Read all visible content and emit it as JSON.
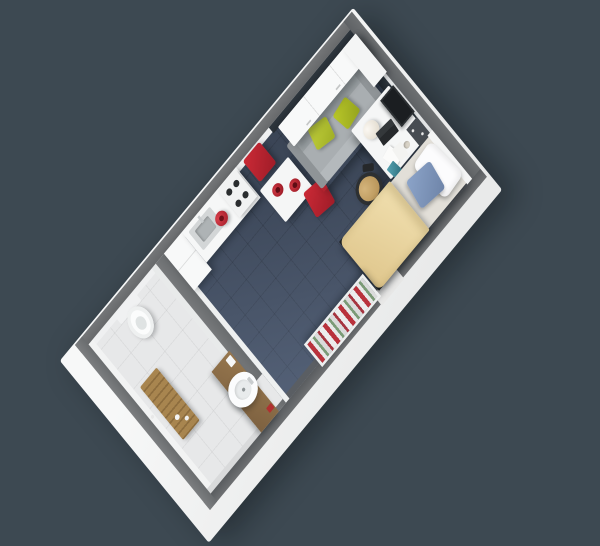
{
  "scene": {
    "description": "Isometric 3D render of a compact studio apartment floor plan with en-suite bathroom, kitchenette, dining table, sofa, study desk and single bed on a dark slate background",
    "background_color": "#3d4952"
  },
  "palette": {
    "bg": "#3d4952",
    "slab": "#f3f4f3",
    "wall": "#6b6e70",
    "wall-dark": "#5c5f62",
    "wall-light": "#7a7c7e",
    "carpet": "#3f4a5c",
    "bath-floor": "#e7e8e9",
    "band": "#2e363d",
    "white": "#f7f8f8",
    "red": "#bf2433",
    "lime": "#b5c431",
    "sofa": "#a9aeb1",
    "sofa-dark": "#8f9497",
    "duvet": "#eedaa9",
    "mattress": "#e2dfd8",
    "pillow-blue": "#8099c0",
    "wood": "#97774e",
    "wood-dark": "#7d6140",
    "teal": "#3a8596",
    "dark": "#222527",
    "steel": "#c9cdcf"
  },
  "rooms": {
    "studio": {
      "label": "Main studio room with dark navy carpet tiles"
    },
    "bathroom": {
      "label": "En-suite bathroom with light grey tiled floor"
    },
    "entry": {
      "label": "Entry door opening in lower wall"
    }
  },
  "furniture": {
    "wall_cabinet": {
      "label": "White overhead storage cupboards above sofa"
    },
    "sofa": {
      "label": "Grey two-seat sofa with two lime green cushions"
    },
    "dining_table": {
      "label": "White square dining table with two red bowls"
    },
    "dining_chair_1": {
      "label": "Red dining chair against wall"
    },
    "dining_chair_2": {
      "label": "Red dining chair beside sofa"
    },
    "kitchen_counter": {
      "label": "White kitchen counter with stainless sink"
    },
    "tall_unit": {
      "label": "Tall white kitchen unit"
    },
    "kettle": {
      "label": "Red kettle on counter"
    },
    "hob": {
      "label": "Four ring hob"
    },
    "desk": {
      "label": "White study desk with sphere lamp, laptop, papers, mug and teal notebook"
    },
    "desk_chair": {
      "label": "Desk chair with tan seat and dark base"
    },
    "monitor": {
      "label": "Wall mounted screen above desk"
    },
    "pinboard": {
      "label": "Dark pinboard with pins above desk"
    },
    "bed": {
      "label": "Single bed with beige duvet, white pillow and slate blue cushion"
    },
    "bookshelf": {
      "label": "Low shelf unit filled with red, green and white books near entry"
    },
    "window_strip": {
      "label": "Dark high-level window strip along upper walls"
    },
    "toilet": {
      "label": "White toilet against bathroom wall"
    },
    "basin": {
      "label": "Round white wash basin on timber vanity shelf"
    },
    "bath_mat": {
      "label": "Timber duckboard bath mat with white toiletry bottles"
    },
    "shower_fixture": {
      "label": "Wall mounted shower fixture"
    }
  }
}
